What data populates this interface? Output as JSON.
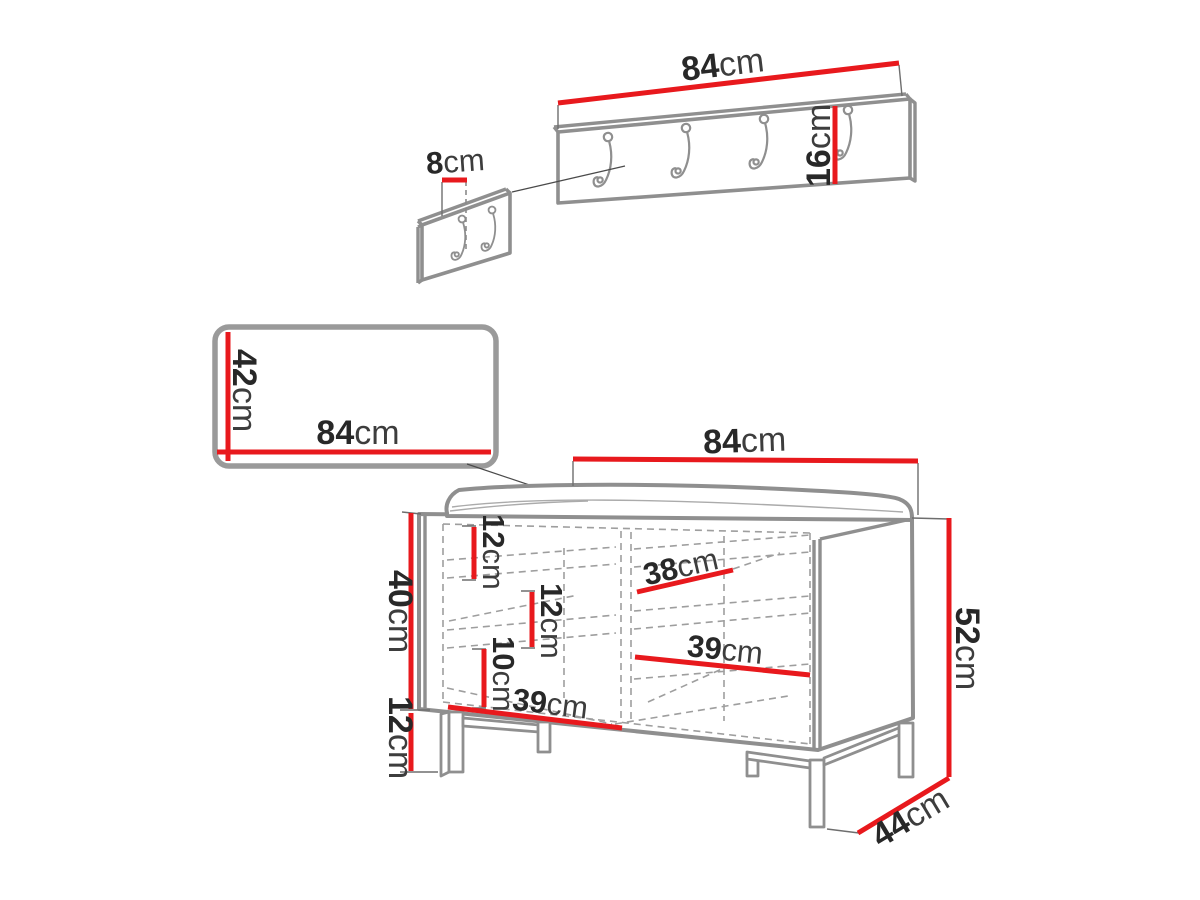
{
  "diagram": {
    "kind": "furniture-dimension-diagram",
    "unit": "cm",
    "colors": {
      "dimension_line": "#e8191d",
      "outline": "#8f8f8f",
      "dashed_line": "#9e9e9e",
      "label_text": "#282828",
      "background": "#ffffff"
    }
  },
  "parts": {
    "coat_rack": {
      "name": "wall coat rack panel",
      "hook_count": 4,
      "width": {
        "num": "84",
        "unit": "cm"
      },
      "height": {
        "num": "16",
        "unit": "cm"
      }
    },
    "hook_detail": {
      "name": "hook spacing detail panel",
      "hook_count": 2,
      "hook_offset": {
        "num": "8",
        "unit": "cm"
      }
    },
    "mirror": {
      "name": "wall panel / mirror",
      "height": {
        "num": "42",
        "unit": "cm"
      },
      "width": {
        "num": "84",
        "unit": "cm"
      }
    },
    "bench": {
      "name": "shoe bench with cushion",
      "width": {
        "num": "84",
        "unit": "cm"
      },
      "height": {
        "num": "52",
        "unit": "cm"
      },
      "depth": {
        "num": "44",
        "unit": "cm"
      },
      "body_height": {
        "num": "40",
        "unit": "cm"
      },
      "leg_height": {
        "num": "12",
        "unit": "cm"
      },
      "interior": {
        "top_gap": {
          "num": "12",
          "unit": "cm"
        },
        "middle_gap": {
          "num": "12",
          "unit": "cm"
        },
        "bottom_gap": {
          "num": "10",
          "unit": "cm"
        },
        "top_shelf_width": {
          "num": "38",
          "unit": "cm"
        },
        "middle_shelf_width": {
          "num": "39",
          "unit": "cm"
        },
        "bottom_shelf_width": {
          "num": "39",
          "unit": "cm"
        }
      }
    }
  }
}
